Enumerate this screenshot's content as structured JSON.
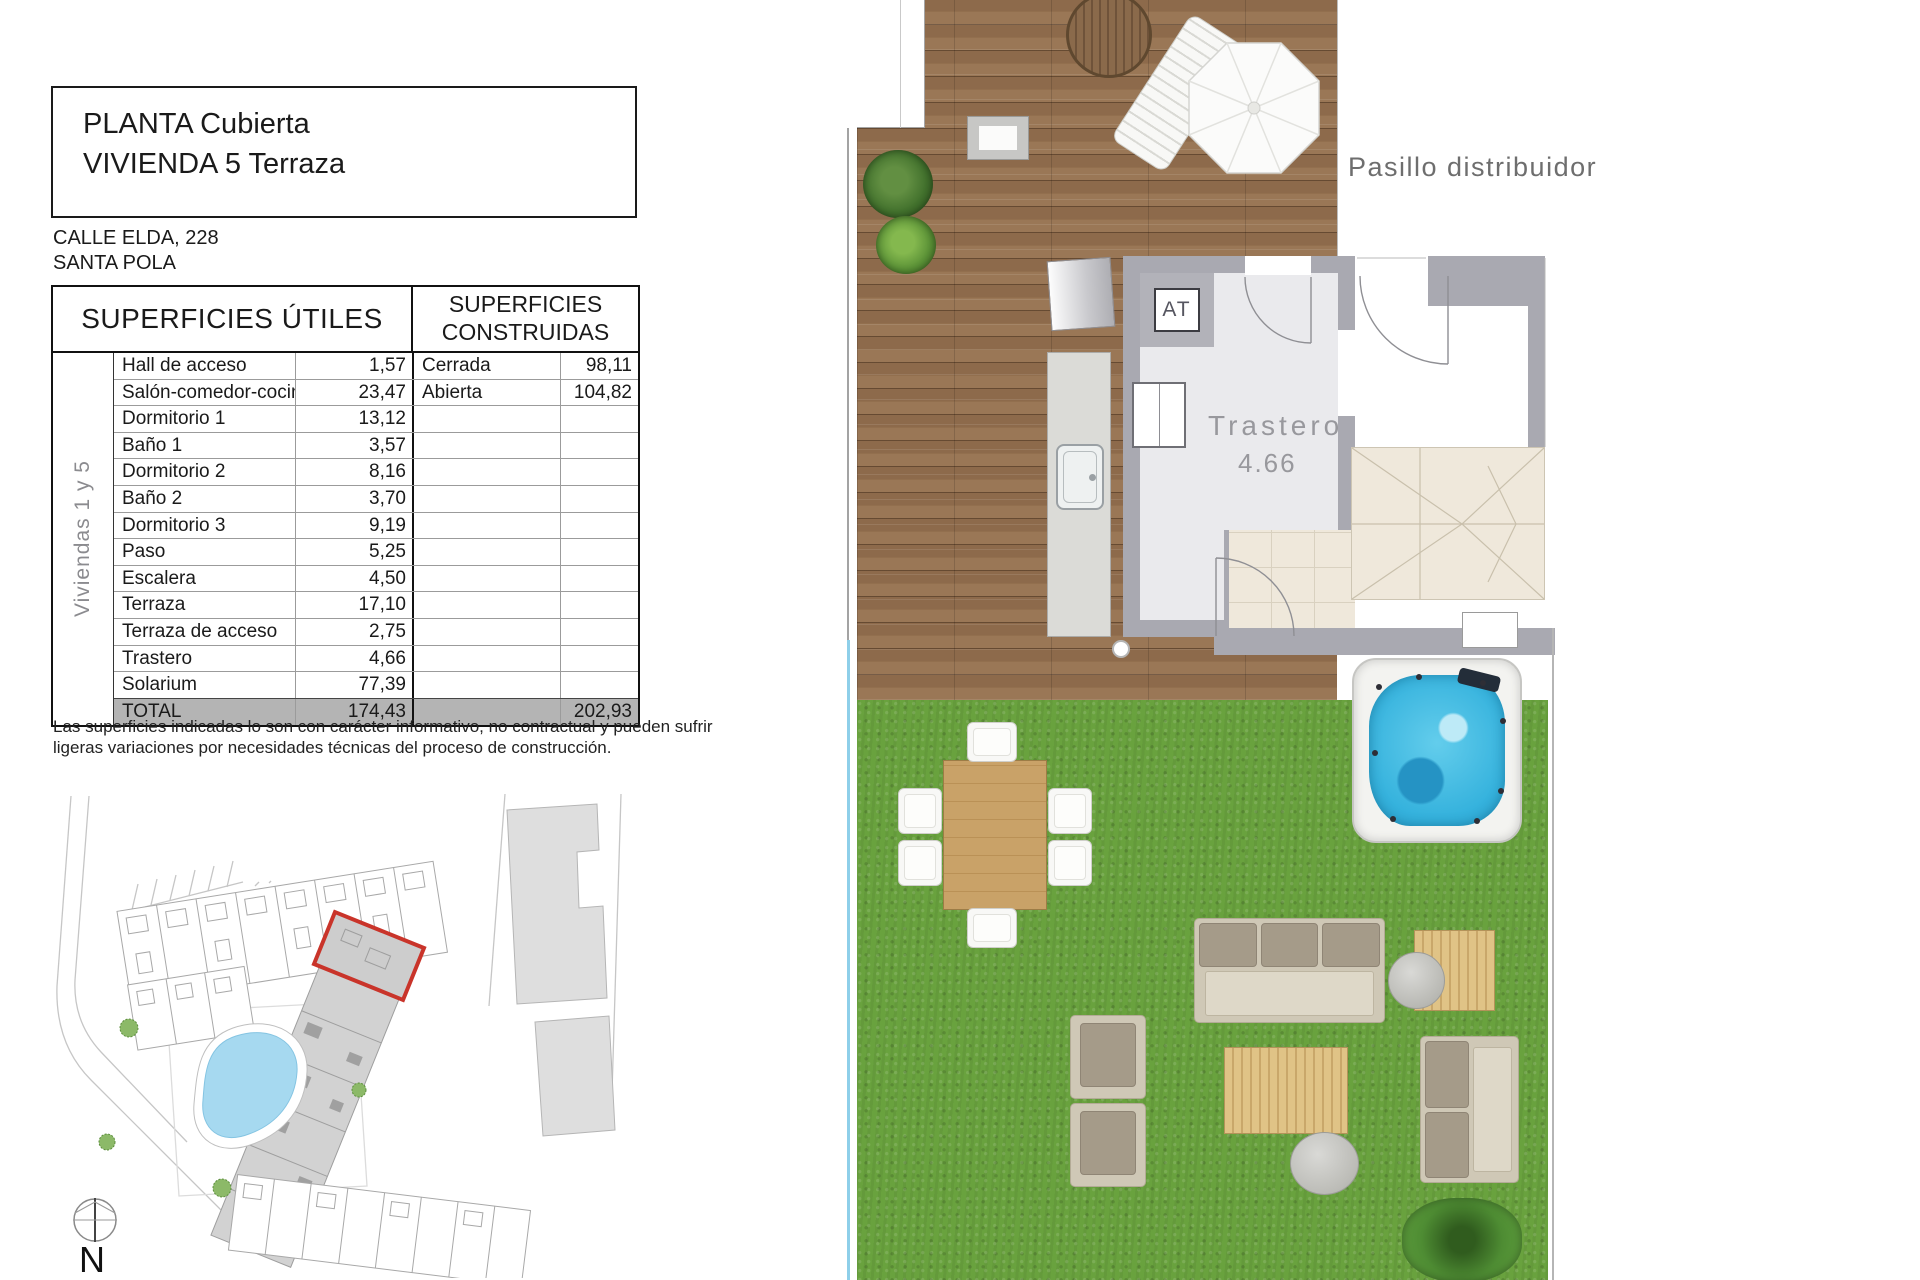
{
  "title_block": {
    "line1": "PLANTA Cubierta",
    "line2": "VIVIENDA 5 Terraza"
  },
  "address": {
    "line1": "CALLE ELDA, 228",
    "line2": "SANTA POLA"
  },
  "areas_table": {
    "header_left": "SUPERFICIES ÚTILES",
    "header_right": "SUPERFICIES CONSTRUIDAS",
    "row_axis_label": "Viviendas 1 y 5",
    "rows": [
      {
        "name": "Hall de acceso",
        "value": "1,57",
        "built_name": "Cerrada",
        "built_value": "98,11"
      },
      {
        "name": "Salón-comedor-cocina",
        "value": "23,47",
        "built_name": "Abierta",
        "built_value": "104,82"
      },
      {
        "name": "Dormitorio 1",
        "value": "13,12",
        "built_name": "",
        "built_value": ""
      },
      {
        "name": "Baño 1",
        "value": "3,57",
        "built_name": "",
        "built_value": ""
      },
      {
        "name": "Dormitorio 2",
        "value": "8,16",
        "built_name": "",
        "built_value": ""
      },
      {
        "name": "Baño 2",
        "value": "3,70",
        "built_name": "",
        "built_value": ""
      },
      {
        "name": "Dormitorio 3",
        "value": "9,19",
        "built_name": "",
        "built_value": ""
      },
      {
        "name": "Paso",
        "value": "5,25",
        "built_name": "",
        "built_value": ""
      },
      {
        "name": "Escalera",
        "value": "4,50",
        "built_name": "",
        "built_value": ""
      },
      {
        "name": "Terraza",
        "value": "17,10",
        "built_name": "",
        "built_value": ""
      },
      {
        "name": "Terraza de acceso",
        "value": "2,75",
        "built_name": "",
        "built_value": ""
      },
      {
        "name": "Trastero",
        "value": "4,66",
        "built_name": "",
        "built_value": ""
      },
      {
        "name": "Solarium",
        "value": "77,39",
        "built_name": "",
        "built_value": ""
      }
    ],
    "total": {
      "name": "TOTAL",
      "value": "174,43",
      "built_value": "202,93"
    }
  },
  "disclaimer": {
    "line1": "Las superficies indicadas lo son con carácter informativo, no contractual y pueden sufrir",
    "line2": "ligeras variaciones por necesidades técnicas del proceso de construcción."
  },
  "floor_plan": {
    "corridor_label": "Pasillo distribuidor",
    "storage_label": "Trastero",
    "storage_area": "4.66",
    "ac_label": "AT"
  },
  "site_plan": {
    "north_label": "N"
  },
  "colors": {
    "highlight_red": "#c9342a",
    "water_blue": "#35b2dd",
    "pool_blue": "#a6d9f0",
    "grass_green": "#69a23e",
    "deck_brown": "#93704f",
    "wall_gray": "#a9a9b1",
    "total_row_gray": "#b4b4b4"
  }
}
